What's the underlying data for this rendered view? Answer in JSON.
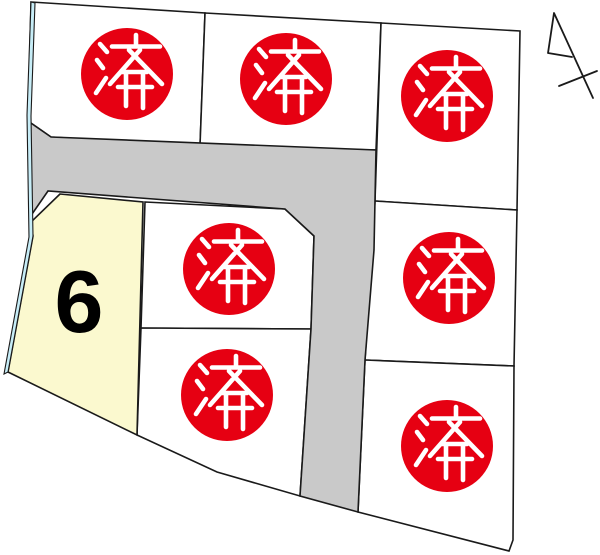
{
  "map": {
    "available_lot_number": "6",
    "lots": [
      {
        "id": "top-left",
        "status": "sold",
        "label": "済"
      },
      {
        "id": "top-center",
        "status": "sold",
        "label": "済"
      },
      {
        "id": "top-right",
        "status": "sold",
        "label": "済"
      },
      {
        "id": "mid-center",
        "status": "sold",
        "label": "済"
      },
      {
        "id": "lower-center",
        "status": "sold",
        "label": "済"
      },
      {
        "id": "mid-right",
        "status": "sold",
        "label": "済"
      },
      {
        "id": "bottom-right",
        "status": "sold",
        "label": "済"
      },
      {
        "id": "lot-6",
        "status": "available",
        "label": "6"
      }
    ],
    "colors": {
      "lot_fill": "#ffffff",
      "road": "#c9c9c9",
      "available_lot": "#fbf9cf",
      "waterway": "#c7edf7",
      "sold_stamp": "#e60012",
      "stamp_text": "#ffffff",
      "boundary": "#1a1a1a",
      "label_text": "#000000"
    },
    "icons": {
      "north_arrow": "north-arrow"
    }
  }
}
